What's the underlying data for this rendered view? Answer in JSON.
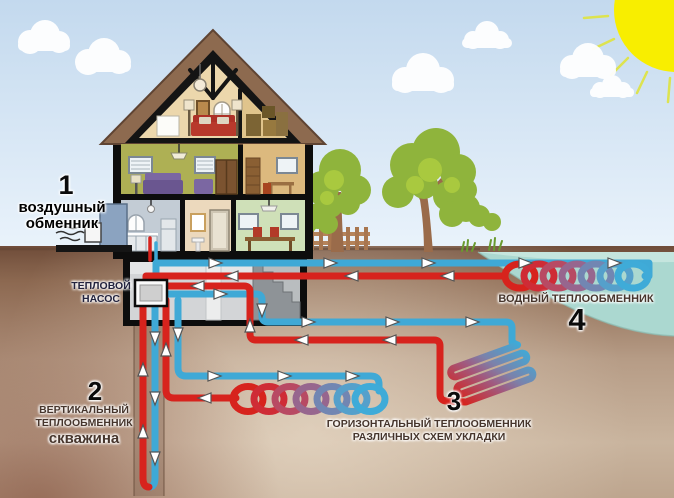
{
  "labels": {
    "air_exchanger": {
      "number": "1",
      "line1": "воздушный",
      "line2": "обменник"
    },
    "heat_pump": {
      "line1": "ТЕПЛОВОЙ",
      "line2": "НАСОС"
    },
    "vertical_exchanger": {
      "number": "2",
      "line1": "ВЕРТИКАЛЬНЫЙ",
      "line2": "ТЕПЛООБМЕННИК",
      "line3": "скважина"
    },
    "horizontal_exchanger": {
      "number": "3",
      "line1": "ГОРИЗОНТАЛЬНЫЙ ТЕПЛООБМЕННИК",
      "line2": "РАЗЛИЧНЫХ СХЕМ УКЛАДКИ"
    },
    "water_exchanger": {
      "number": "4",
      "line1": "ВОДНЫЙ ТЕПЛООБМЕННИК"
    }
  },
  "colors": {
    "hot_pipe": "#d7231d",
    "cold_pipe": "#3fa9d6",
    "pond_water": "#abd8d0",
    "sun": "#f8ee00",
    "sky": "#cfe2f3",
    "ground_top": "#7a5844",
    "tree_foliage": "#8fb43c",
    "roof": "#8d6a4f"
  }
}
